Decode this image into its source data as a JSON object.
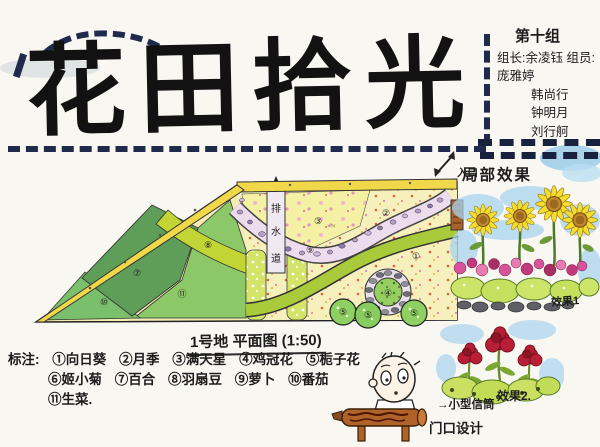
{
  "title": "花田拾光",
  "header": {
    "group": "第十组",
    "leader_label": "组长:",
    "leader": "余凌钰",
    "members_label": "组员:",
    "members": [
      "庞雅婷",
      "韩尚行",
      "钟明月",
      "刘行舸"
    ]
  },
  "plan": {
    "caption": "1号地 平面图 (1:50)",
    "entrance_label": "入口",
    "path_chars": [
      "排",
      "水",
      "道"
    ],
    "zones": [
      "③",
      "②",
      "①",
      "⑨",
      "⑧",
      "⑦",
      "⑩",
      "⑪",
      "④",
      "⑤",
      "⑤",
      "⑤"
    ]
  },
  "legend": {
    "label": "标注:",
    "items": [
      {
        "num": "①",
        "name": "向日葵"
      },
      {
        "num": "②",
        "name": "月季"
      },
      {
        "num": "③",
        "name": "满天星"
      },
      {
        "num": "④",
        "name": "鸡冠花"
      },
      {
        "num": "⑤",
        "name": "栀子花"
      },
      {
        "num": "⑥",
        "name": "姬小菊"
      },
      {
        "num": "⑦",
        "name": "百合"
      },
      {
        "num": "⑧",
        "name": "羽扇豆"
      },
      {
        "num": "⑨",
        "name": "萝卜"
      },
      {
        "num": "⑩",
        "name": "番茄"
      },
      {
        "num": "⑪",
        "name": "生菜."
      }
    ]
  },
  "effects": {
    "heading": "局部效果",
    "label1": "效果1",
    "label2": "效果2."
  },
  "footer": {
    "sign_note": "→小型信筒",
    "design_note": "门口设计"
  },
  "colors": {
    "dash_navy": "#1f2a4d",
    "title_ink": "#121212",
    "plan_yellow_strip": "#f0d84a",
    "dark_green": "#5f9e58",
    "mid_green": "#7ac06c",
    "light_green": "#8cc768",
    "band_green": "#c3d534",
    "ribbon_green": "#a9ca3a",
    "pebble_path": "#ecdcee",
    "sunflower": "#f4dc30",
    "cockscomb_red": "#b81f34",
    "sky_blue": "#a8d4ee",
    "wood_brown": "#b06228"
  }
}
